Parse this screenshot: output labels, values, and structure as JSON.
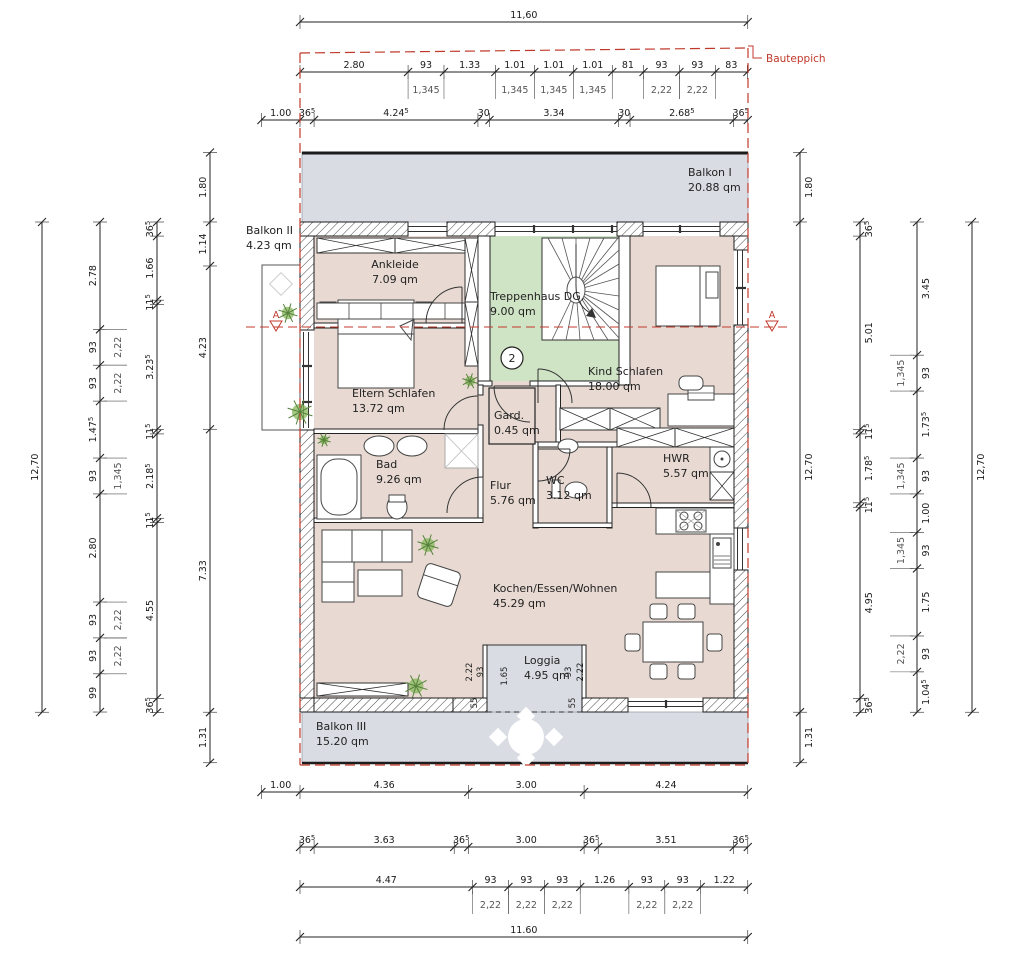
{
  "drawing": {
    "bauteppich_label": "Bauteppich",
    "section_marker": "A",
    "stair_point_number": "2"
  },
  "colors": {
    "accent_red": "#c0392b",
    "room_fill": "#e8dad2",
    "balcony_fill": "#d9dde3",
    "stair_fill": "#cfe3c5",
    "wall_line": "#1c1c1c"
  },
  "rooms": [
    {
      "id": "balkon1",
      "name": "Balkon I",
      "area": "20.88 qm"
    },
    {
      "id": "balkon2",
      "name": "Balkon II",
      "area": "4.23 qm"
    },
    {
      "id": "ankleide",
      "name": "Ankleide",
      "area": "7.09 qm"
    },
    {
      "id": "treppenhaus",
      "name": "Treppenhaus DG.",
      "area": "9.00 qm"
    },
    {
      "id": "kind",
      "name": "Kind Schlafen",
      "area": "18.00 qm"
    },
    {
      "id": "eltern",
      "name": "Eltern Schlafen",
      "area": "13.72 qm"
    },
    {
      "id": "gard",
      "name": "Gard.",
      "area": "0.45 qm"
    },
    {
      "id": "bad",
      "name": "Bad",
      "area": "9.26 qm"
    },
    {
      "id": "flur",
      "name": "Flur",
      "area": "5.76 qm"
    },
    {
      "id": "wc",
      "name": "WC",
      "area": "3.12 qm"
    },
    {
      "id": "hwr",
      "name": "HWR",
      "area": "5.57 qm"
    },
    {
      "id": "wohnen",
      "name": "Kochen/Essen/Wohnen",
      "area": "45.29 qm"
    },
    {
      "id": "loggia",
      "name": "Loggia",
      "area": "4.95 qm"
    },
    {
      "id": "balkon3",
      "name": "Balkon III",
      "area": "15.20 qm"
    }
  ],
  "dimensions": {
    "top_overall": {
      "values": [
        {
          "t": "11,60",
          "m": 11.6
        }
      ]
    },
    "top_openings": {
      "values": [
        {
          "t": "2.80",
          "m": 2.8
        },
        {
          "t": "93",
          "m": 0.93
        },
        {
          "t": "1.33",
          "m": 1.33
        },
        {
          "t": "1.01",
          "m": 1.01
        },
        {
          "t": "1.01",
          "m": 1.01
        },
        {
          "t": "1.01",
          "m": 1.01
        },
        {
          "t": "81",
          "m": 0.81
        },
        {
          "t": "93",
          "m": 0.93
        },
        {
          "t": "93",
          "m": 0.93
        },
        {
          "t": "83",
          "m": 0.83
        }
      ],
      "subs": [
        {
          "i": 1,
          "t": "1,345"
        },
        {
          "i": 3,
          "t": "1,345"
        },
        {
          "i": 4,
          "t": "1,345"
        },
        {
          "i": 5,
          "t": "1,345"
        },
        {
          "i": 7,
          "t": "2,22"
        },
        {
          "i": 8,
          "t": "2,22"
        }
      ]
    },
    "top_walls": {
      "values": [
        {
          "t": "1.00",
          "m": 1.0
        },
        {
          "t": "36⁵",
          "m": 0.365
        },
        {
          "t": "4.24⁵",
          "m": 4.245
        },
        {
          "t": "30",
          "m": 0.3
        },
        {
          "t": "3.34",
          "m": 3.34
        },
        {
          "t": "30",
          "m": 0.3
        },
        {
          "t": "2.68⁵",
          "m": 2.685
        },
        {
          "t": "36⁵",
          "m": 0.365
        }
      ]
    },
    "bottom_main": {
      "values": [
        {
          "t": "1.00",
          "m": 1.0
        },
        {
          "t": "4.36",
          "m": 4.36
        },
        {
          "t": "3.00",
          "m": 3.0
        },
        {
          "t": "4.24",
          "m": 4.24
        }
      ]
    },
    "bottom_walls": {
      "values": [
        {
          "t": "36⁵",
          "m": 0.365
        },
        {
          "t": "3.63",
          "m": 3.63
        },
        {
          "t": "36⁵",
          "m": 0.365
        },
        {
          "t": "3.00",
          "m": 3.0
        },
        {
          "t": "36⁵",
          "m": 0.365
        },
        {
          "t": "3.51",
          "m": 3.51
        },
        {
          "t": "36⁵",
          "m": 0.365
        }
      ]
    },
    "bottom_openings": {
      "values": [
        {
          "t": "4.47",
          "m": 4.47
        },
        {
          "t": "93",
          "m": 0.93
        },
        {
          "t": "93",
          "m": 0.93
        },
        {
          "t": "93",
          "m": 0.93
        },
        {
          "t": "1.26",
          "m": 1.26
        },
        {
          "t": "93",
          "m": 0.93
        },
        {
          "t": "93",
          "m": 0.93
        },
        {
          "t": "1.22",
          "m": 1.22
        }
      ],
      "subs": [
        {
          "i": 1,
          "t": "2,22"
        },
        {
          "i": 2,
          "t": "2,22"
        },
        {
          "i": 3,
          "t": "2,22"
        },
        {
          "i": 5,
          "t": "2,22"
        },
        {
          "i": 6,
          "t": "2,22"
        }
      ]
    },
    "bottom_overall": {
      "values": [
        {
          "t": "11.60",
          "m": 11.6
        }
      ]
    },
    "left_overall": {
      "values": [
        {
          "t": "12,70",
          "m": 12.7
        }
      ]
    },
    "left_rooms": {
      "values": [
        {
          "t": "2.78",
          "m": 2.78
        },
        {
          "t": "93",
          "m": 0.93
        },
        {
          "t": "93",
          "m": 0.93
        },
        {
          "t": "1.47⁵",
          "m": 1.475
        },
        {
          "t": "93",
          "m": 0.93
        },
        {
          "t": "2.80",
          "m": 2.8
        },
        {
          "t": "93",
          "m": 0.93
        },
        {
          "t": "93",
          "m": 0.93
        },
        {
          "t": "99",
          "m": 0.99
        }
      ],
      "subs": [
        {
          "i": 1,
          "t": "2,22"
        },
        {
          "i": 2,
          "t": "2,22"
        },
        {
          "i": 4,
          "t": "1,345"
        },
        {
          "i": 6,
          "t": "2,22"
        },
        {
          "i": 7,
          "t": "2,22"
        }
      ]
    },
    "left_walls": {
      "values": [
        {
          "t": "36⁵",
          "m": 0.365
        },
        {
          "t": "1.66",
          "m": 1.66
        },
        {
          "t": "11⁵",
          "m": 0.115
        },
        {
          "t": "3.23⁵",
          "m": 3.235
        },
        {
          "t": "11⁵",
          "m": 0.115
        },
        {
          "t": "2.18⁵",
          "m": 2.185
        },
        {
          "t": "11⁵",
          "m": 0.115
        },
        {
          "t": "4.55",
          "m": 4.55
        },
        {
          "t": "36⁵",
          "m": 0.365
        }
      ]
    },
    "left_outer": {
      "values": [
        {
          "t": "1.80",
          "m": 1.8
        },
        {
          "t": "1.14",
          "m": 1.14
        },
        {
          "t": "4.23",
          "m": 4.23
        },
        {
          "t": "7.33",
          "m": 7.33
        },
        {
          "t": "1.31",
          "m": 1.31
        }
      ]
    },
    "right_outer": {
      "values": [
        {
          "t": "1.80",
          "m": 1.8
        },
        {
          "t": "12.70",
          "m": 12.7
        },
        {
          "t": "1.31",
          "m": 1.31
        }
      ]
    },
    "right_walls": {
      "values": [
        {
          "t": "36⁵",
          "m": 0.365
        },
        {
          "t": "5.01",
          "m": 5.01
        },
        {
          "t": "11⁵",
          "m": 0.115
        },
        {
          "t": "1.78⁵",
          "m": 1.785
        },
        {
          "t": "11⁵",
          "m": 0.115
        },
        {
          "t": "4.95",
          "m": 4.95
        },
        {
          "t": "36⁵",
          "m": 0.365
        }
      ]
    },
    "right_openings": {
      "values": [
        {
          "t": "3.45",
          "m": 3.45
        },
        {
          "t": "93",
          "m": 0.93
        },
        {
          "t": "1.73⁵",
          "m": 1.735
        },
        {
          "t": "93",
          "m": 0.93
        },
        {
          "t": "1.00",
          "m": 1.0
        },
        {
          "t": "93",
          "m": 0.93
        },
        {
          "t": "1.75",
          "m": 1.75
        },
        {
          "t": "93",
          "m": 0.93
        },
        {
          "t": "1.04⁵",
          "m": 1.045
        }
      ],
      "subs": [
        {
          "i": 1,
          "t": "1,345"
        },
        {
          "i": 3,
          "t": "1,345"
        },
        {
          "i": 5,
          "t": "1,345"
        },
        {
          "i": 7,
          "t": "2,22"
        }
      ]
    },
    "right_overall": {
      "values": [
        {
          "t": "12,70",
          "m": 12.7
        }
      ]
    }
  },
  "loggia_dims": [
    "2.22",
    "93",
    "1.65",
    "93",
    "2.22",
    "55",
    "55"
  ]
}
